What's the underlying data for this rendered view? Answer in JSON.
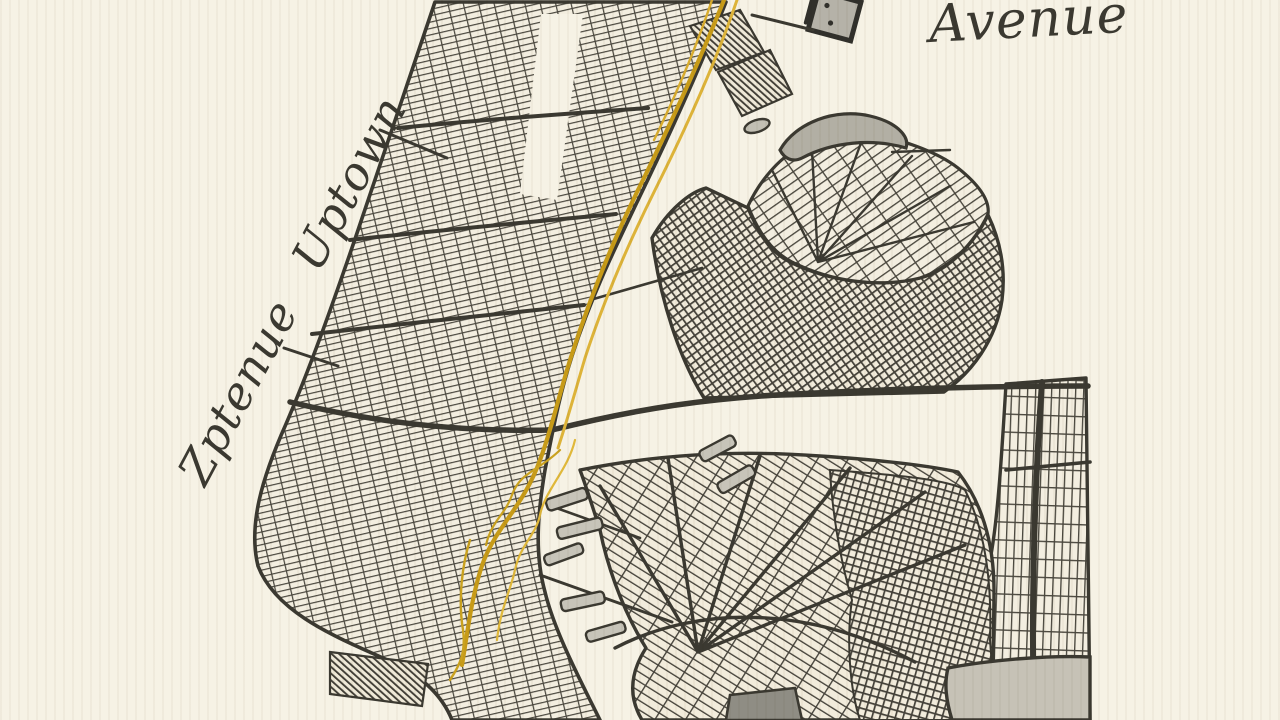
{
  "page": {
    "background_color": "#F6F2E5",
    "ink_color": "#3B3931",
    "style": "hand-drawn vintage city street map"
  },
  "labels": {
    "avenue": "Avenue",
    "uptown": "Zptenue Uptown"
  },
  "route": {
    "name": "highlighted-avenue-route",
    "color": "#C79B18",
    "color_light": "#DDB339"
  },
  "marker": {
    "name": "building-marker",
    "fill": "#B5B2A8"
  }
}
